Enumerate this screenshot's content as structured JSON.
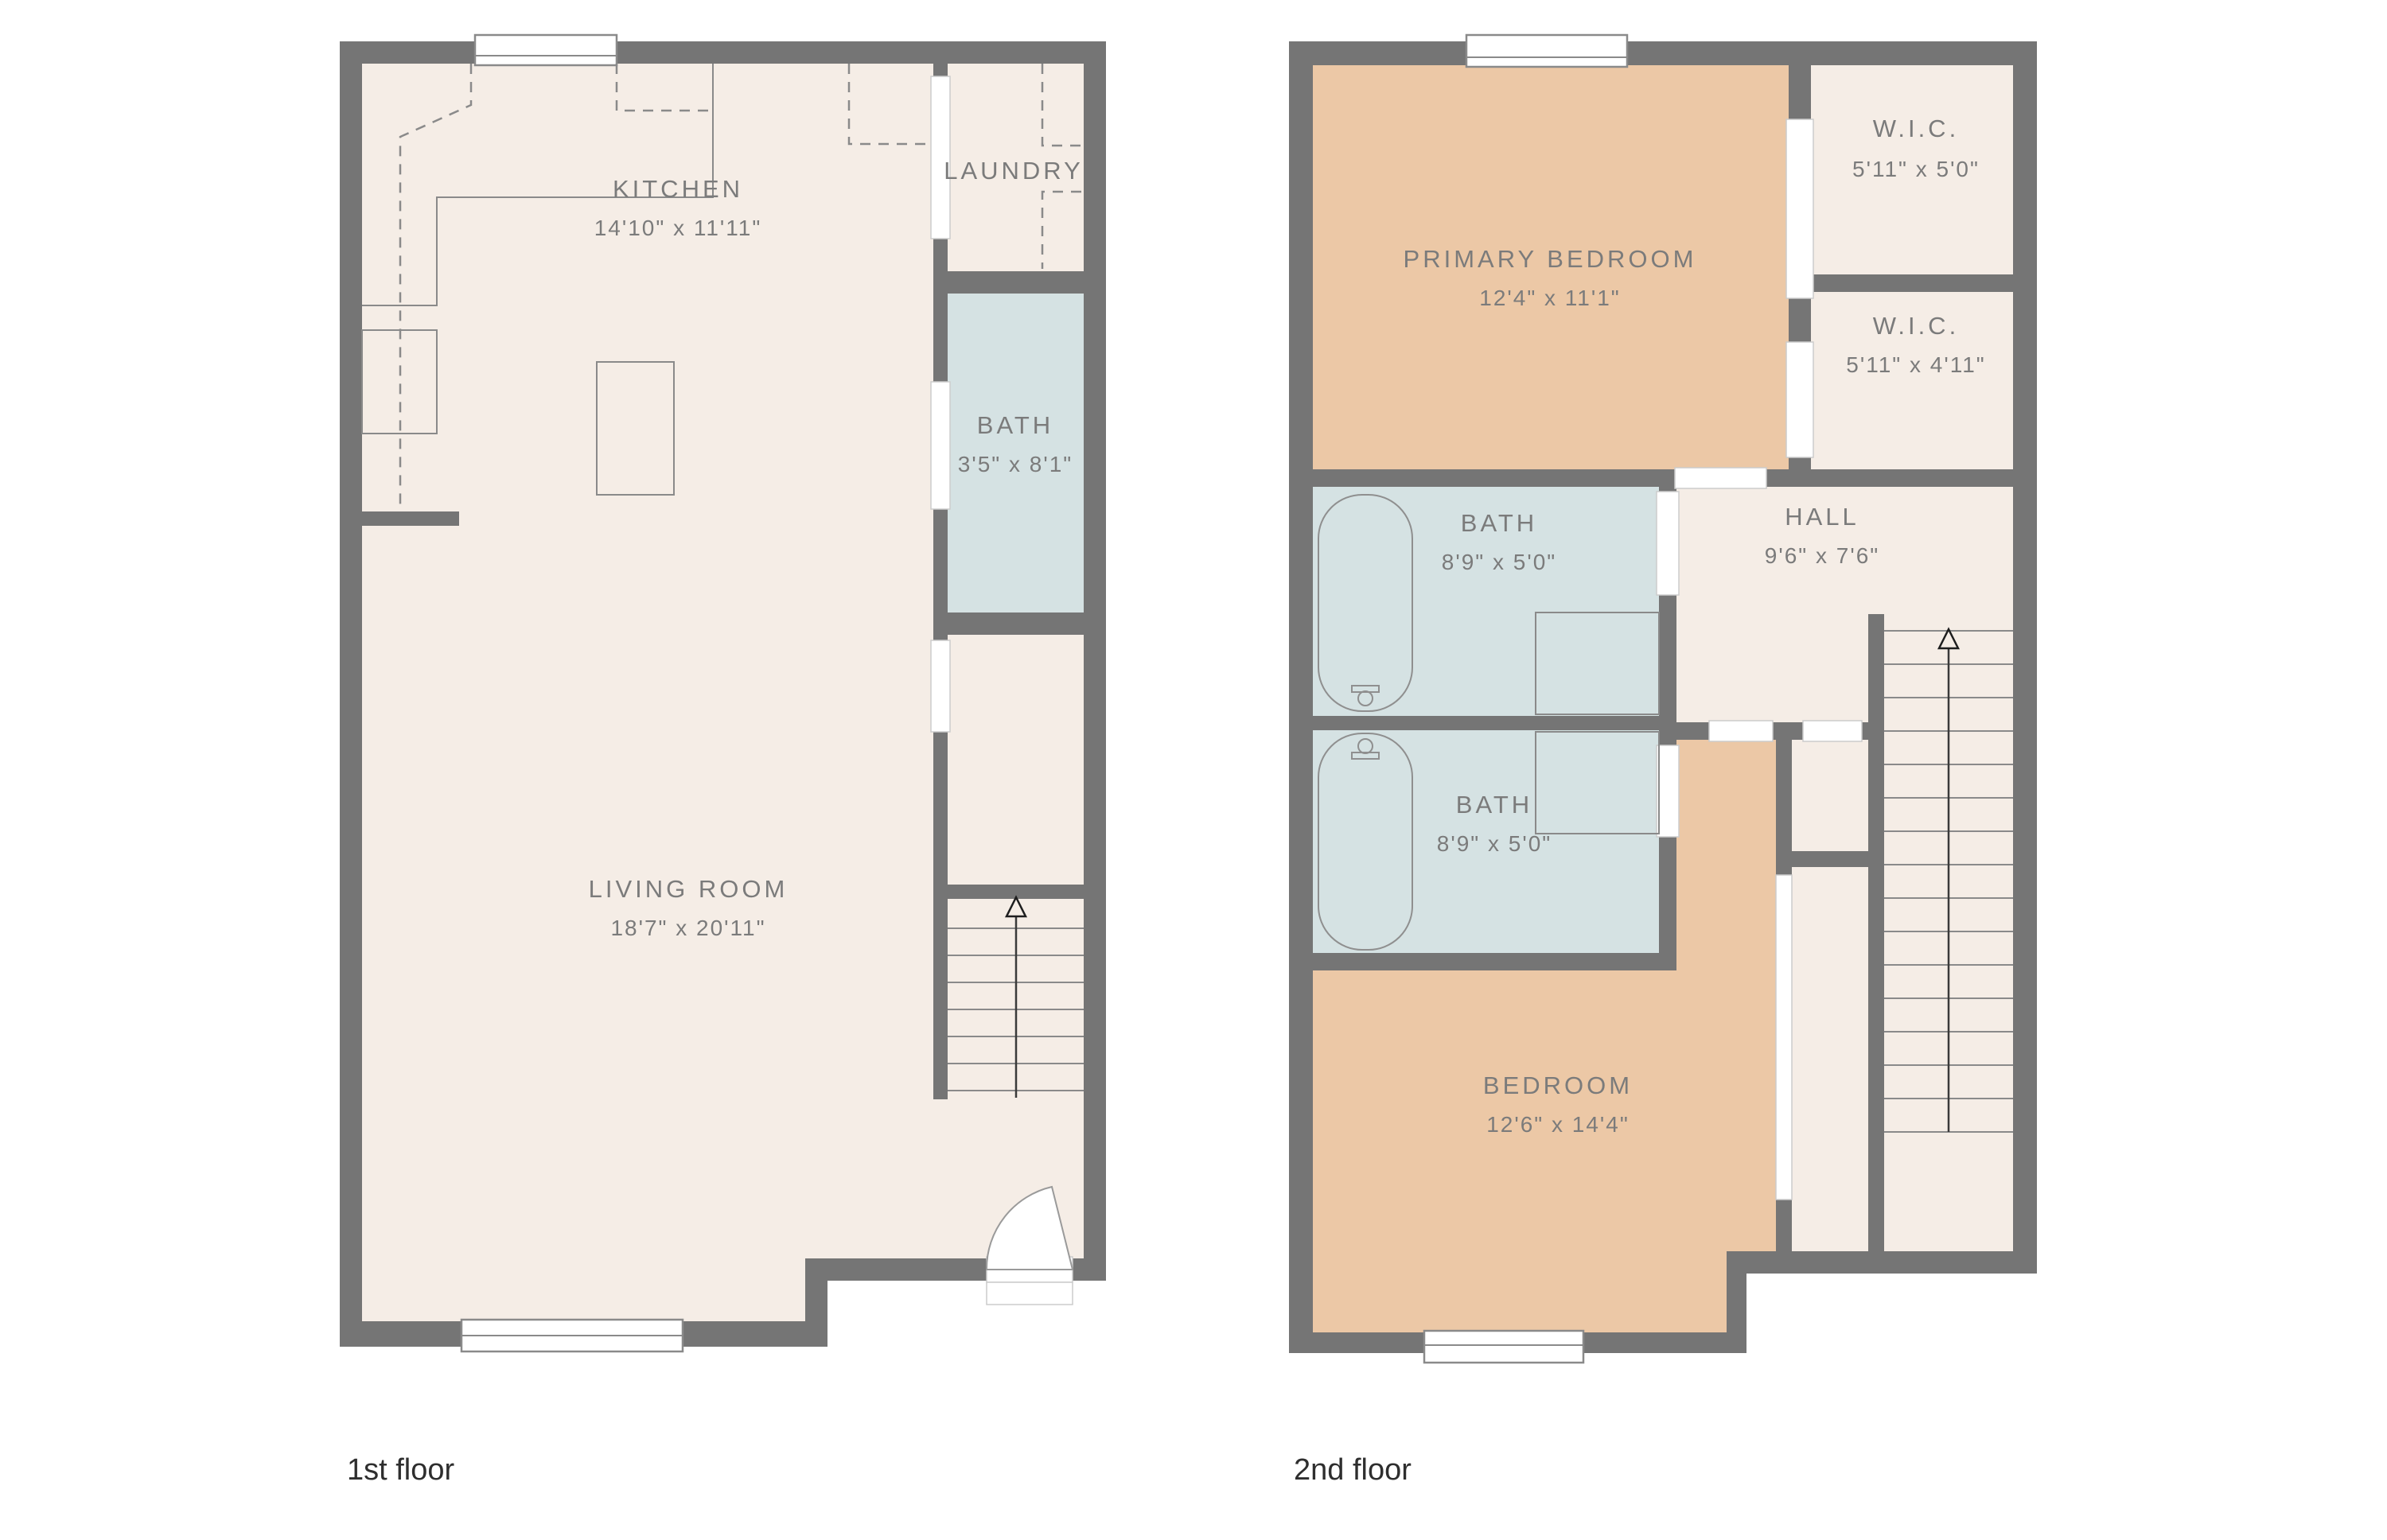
{
  "palette": {
    "wall_gray": "#757575",
    "floor_cream": "#f5ede6",
    "floor_tan": "#ecc8a6",
    "floor_blue": "#d5e2e3",
    "label_gray": "#7b7b7b",
    "caption_dark": "#2e2e2e",
    "background": "#ffffff"
  },
  "floor1": {
    "caption": "1st floor",
    "rooms": {
      "kitchen": {
        "name": "KITCHEN",
        "dims": "14'10\" x 11'11\""
      },
      "laundry": {
        "name": "LAUNDRY",
        "dims": ""
      },
      "bath": {
        "name": "BATH",
        "dims": "3'5\" x 8'1\""
      },
      "living": {
        "name": "LIVING ROOM",
        "dims": "18'7\" x 20'11\""
      }
    }
  },
  "floor2": {
    "caption": "2nd floor",
    "rooms": {
      "primary": {
        "name": "PRIMARY BEDROOM",
        "dims": "12'4\" x 11'1\""
      },
      "wic1": {
        "name": "W.I.C.",
        "dims": "5'11\" x 5'0\""
      },
      "wic2": {
        "name": "W.I.C.",
        "dims": "5'11\" x 4'11\""
      },
      "bath1": {
        "name": "BATH",
        "dims": "8'9\" x 5'0\""
      },
      "hall": {
        "name": "HALL",
        "dims": "9'6\" x 7'6\""
      },
      "bath2": {
        "name": "BATH",
        "dims": "8'9\" x 5'0\""
      },
      "bedroom": {
        "name": "BEDROOM",
        "dims": "12'6\" x 14'4\""
      }
    }
  }
}
